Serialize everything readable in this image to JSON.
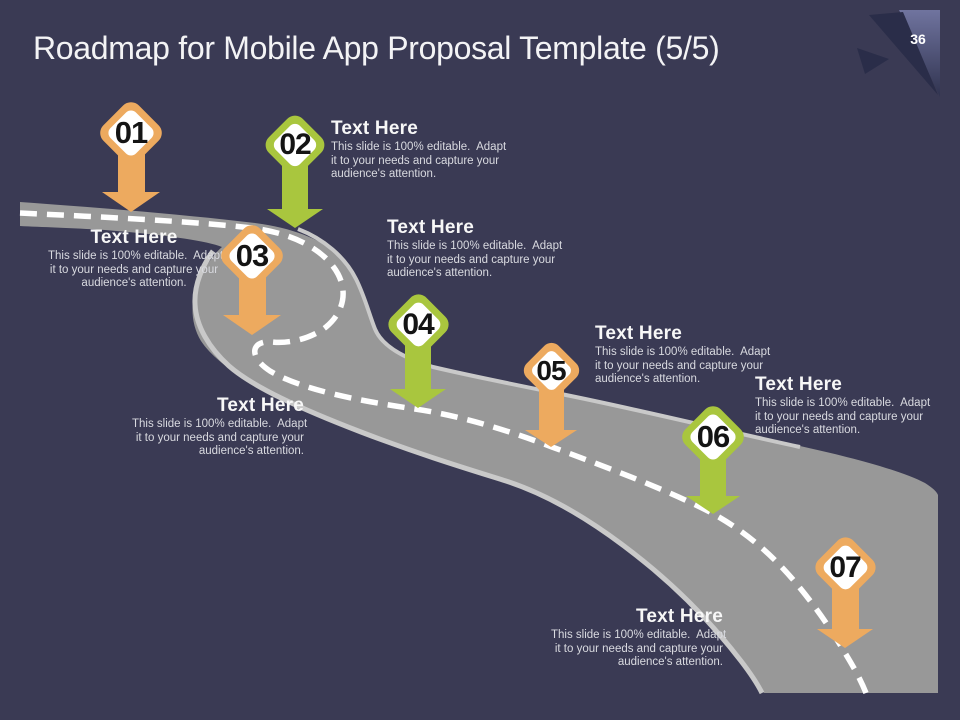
{
  "slide": {
    "title": "Roadmap for Mobile App Proposal Template (5/5)",
    "page_number": "36"
  },
  "colors": {
    "background": "#3A3A54",
    "road": "#989898",
    "road_edge": "#C9C9C9",
    "road_dash": "#FFFFFF",
    "orange": "#EDAA5F",
    "green": "#A9C63E",
    "diamond_fill": "#FFFFFF",
    "number_text": "#141414",
    "heading_text": "#F7F7F7",
    "body_text": "#D9DAE0",
    "title_text": "#F3F3F5",
    "corner_dark": "#2A2D49",
    "corner_light": "#70749F"
  },
  "milestones": [
    {
      "number": "01",
      "color": "orange",
      "heading": "Text Here",
      "body_lines": [
        "This slide is 100% editable.  Adapt",
        "it to your needs and capture your",
        "audience's attention."
      ]
    },
    {
      "number": "02",
      "color": "green",
      "heading": "Text Here",
      "body_lines": [
        "This slide is 100% editable.  Adapt",
        "it to your needs and capture your",
        "audience's attention."
      ]
    },
    {
      "number": "03",
      "color": "orange",
      "heading": "Text Here",
      "body_lines": [
        "This slide is 100% editable.  Adapt",
        "it to your needs and capture your",
        "audience's attention."
      ]
    },
    {
      "number": "04",
      "color": "green",
      "heading": "Text Here",
      "body_lines": [
        "This slide is 100% editable.  Adapt",
        "it to your needs and capture your",
        "audience's attention."
      ]
    },
    {
      "number": "05",
      "color": "orange",
      "heading": "Text Here",
      "body_lines": [
        "This slide is 100% editable.  Adapt",
        "it to your needs and capture your",
        "audience's attention."
      ]
    },
    {
      "number": "06",
      "color": "green",
      "heading": "Text Here",
      "body_lines": [
        "This slide is 100% editable.  Adapt",
        "it to your needs and capture your",
        "audience's attention."
      ]
    },
    {
      "number": "07",
      "color": "orange",
      "heading": "Text Here",
      "body_lines": [
        "This slide is 100% editable.  Adapt",
        "it to your needs and capture your",
        "audience's attention."
      ]
    }
  ]
}
